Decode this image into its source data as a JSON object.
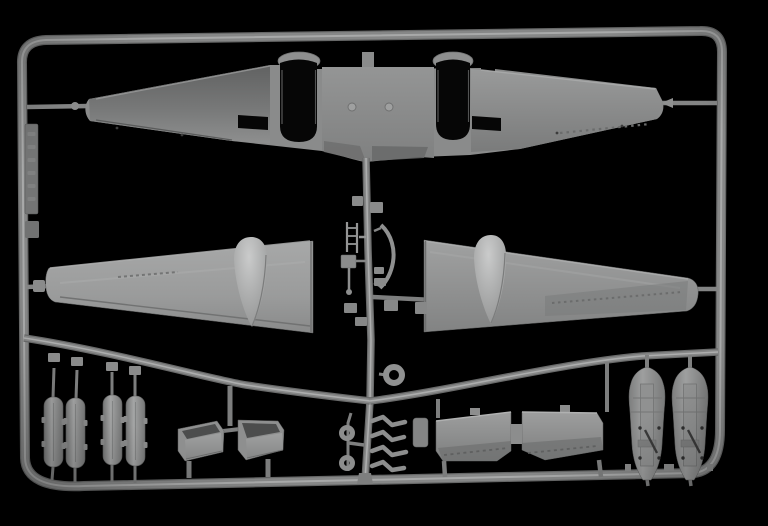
{
  "scene": {
    "subject": "Photograph of a gray injection-molded plastic model kit sprue for a twin-engine aircraft, shot on a black background",
    "background_color": "#000000"
  },
  "colors": {
    "background": "#000000",
    "runner_base": "#868787",
    "runner_shadow": "#696a6a",
    "runner_highlight": "#b0b1b1",
    "frame_shadow": "#676868",
    "frame_highlight": "#aeafaf",
    "plastic_base": "#8a8b8b",
    "plastic_dark": "#6e6f6f",
    "plastic_light": "#a4a5a5",
    "opening_black": "#060606",
    "detail_dark": "#3a3a3a"
  },
  "parts": {
    "frame": "Rectangular sprue frame with rounded corners",
    "runners": "Internal runners connecting the molded parts",
    "upper_wing": "One-piece upper wing with twin engine nacelle openings",
    "nacelle_opening_left": "Left engine nacelle opening",
    "nacelle_opening_right": "Right engine nacelle opening",
    "lower_wing_left": "Left lower wing half with nacelle fairing bulge",
    "lower_wing_right": "Right lower wing half with nacelle fairing bulge",
    "nacelle_fairing_left": "Left underwing nacelle fairing",
    "nacelle_fairing_right": "Right underwing nacelle fairing",
    "gear_doors": "Four main landing gear door halves",
    "radiator_housings": "Two radiator housing scoops",
    "flap_section": "Two-part trailing edge flap section",
    "drop_tanks": "Two drop tank halves with interior detail",
    "exhaust_stubs": "Four exhaust stub parts",
    "tail_wheel_ring": "Ring-shaped part",
    "main_wheels": "Two small wheel parts",
    "antenna_mast": "Small ladder-style mast part",
    "df_loop": "Curved bow-shaped bracket part",
    "small_fittings": "Assorted small fittings on the center runner",
    "part_tag": "Embossed part-number tab on the left frame rail"
  }
}
